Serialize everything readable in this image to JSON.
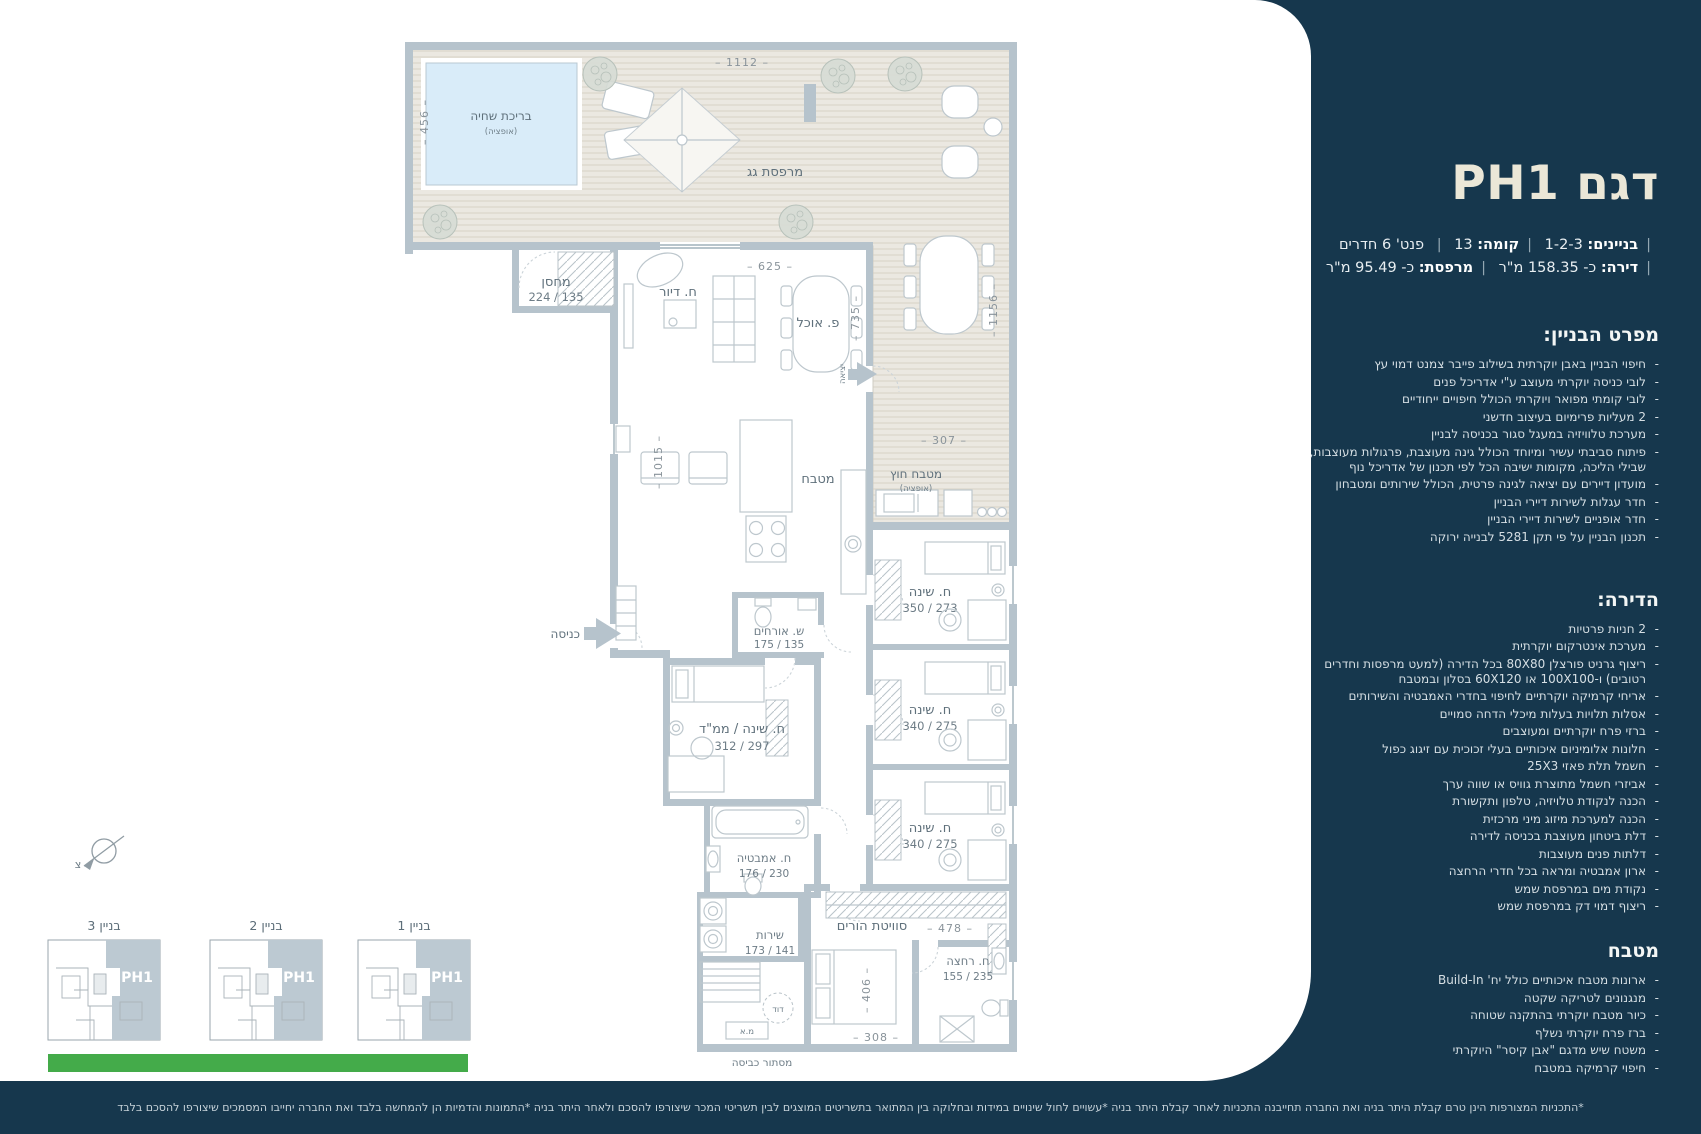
{
  "colors": {
    "navy": "#16374d",
    "cream": "#ebe7d7",
    "green": "#44ab4a",
    "wall": "#b6c3cc",
    "deck": "#ebe8e1",
    "pool": "#d9ecf9",
    "label": "#5f707b",
    "highlight": "#bcc9d2"
  },
  "sidebar": {
    "title": "דגם PH1",
    "separator": "|",
    "meta1": [
      {
        "b": "בניינים:",
        "t": "1-2-3"
      },
      {
        "b": "קומה:",
        "t": "13"
      },
      {
        "b": "",
        "t": "פנט' 6 חדרים"
      }
    ],
    "meta2": [
      {
        "b": "דירה:",
        "t": "כ- 158.35 מ\"ר"
      },
      {
        "b": "מרפסת:",
        "t": "כ- 95.49 מ\"ר"
      }
    ],
    "building_spec": {
      "heading": "מפרט הבניין:",
      "items": [
        "חיפוי הבניין באבן יוקרתית בשילוב פייבר צמנט דמוי עץ",
        "לובי כניסה יוקרתי מעוצב ע\"י אדריכל פנים",
        "לובי קומתי מפואר ויוקרתי הכולל חיפויים ייחודיים",
        "2 מעליות פרימיום בעיצוב חדשני",
        "מערכת טלוויזיה במעגל סגור בכניסה לבניין",
        "פיתוח סביבתי עשיר ומיוחד הכולל גינה מעוצבת, פרגולות מעוצבות, שבילי הליכה, מקומות ישיבה הכל לפי תכנון של אדריכל נוף",
        "מועדון דיירים עם יציאה לגינה פרטית, הכולל שירותים ומטבחון",
        "חדר עגלות לשירות דיירי הבניין",
        "חדר אופניים לשירות דיירי הבניין",
        "תכנון הבניין על פי תקן 5281 לבנייה ירוקה"
      ]
    },
    "apartment_spec": {
      "heading": "הדירה:",
      "items": [
        "2 חניות פרטיות",
        "מערכת אינטרקום יוקרתית",
        "ריצוף גרניט פורצלן 80X80 בכל הדירה (למעט מרפסות וחדרים רטובים) ו-100X100 או 60X120 בסלון ובמטבח",
        "אריחי קרמיקה יוקרתיים לחיפוי בחדרי האמבטיה והשירותים",
        "אסלות תלויות בעלות מיכלי הדחה סמויים",
        "ברזי פרח יוקרתיים ומעוצבים",
        "חלונות אלומיניום איכותיים בעלי זכוכית עם זיגוג כפול",
        "חשמל תלת פאזי 25X3",
        "אביזרי חשמל מתוצרת גוויס או שווה ערך",
        "הכנה לנקודת טלויזיה, טלפון ותקשורת",
        "הכנה למערכת מיזוג מיני מרכזית",
        "דלת ביטחון מעוצבת בכניסה לדירה",
        "דלתות פנים מעוצבות",
        "ארון אמבטיה ומראה בכל חדרי הרחצה",
        "נקודת מים במרפסת שמש",
        "ריצוף דמוי דק במרפסת שמש"
      ]
    },
    "kitchen_spec": {
      "heading": "מטבח",
      "items": [
        "ארונות מטבח איכותיים כולל יח' Build-In",
        "מנגנונים לטריקה שקטה",
        "כיור מטבח יוקרתי בהתקנה שטוחה",
        "ברז פרח יוקרתי נשלף",
        "משטח שיש מדגם \"אבן קיסר\" היוקרתי",
        "חיפוי קרמיקה במטבח"
      ]
    }
  },
  "plan": {
    "labels": {
      "roof_terrace": "מרפסת גג",
      "pool": "בריכת שחיה",
      "option": "(אופציה)",
      "storage": "מחסן",
      "storage_dims": "224 / 135",
      "living": "ח. דיור",
      "dining": "פ. אוכל",
      "kitchen": "מטבח",
      "outdoor_kitchen": "מטבח חוץ",
      "entrance": "כניסה",
      "exit": "יציאה",
      "guest_wc": "ש. אורחים",
      "guest_wc_dims": "175 / 135",
      "mamad": "ח. שינה / ממ\"ד",
      "mamad_dims": "312 / 297",
      "bedroom": "ח. שינה",
      "bedroom1_dims": "350 / 273",
      "bedroom2_dims": "340 / 275",
      "bedroom3_dims": "340 / 275",
      "master": "סוויטת הורים",
      "master_bath": "ח. רחצה",
      "master_bath_dims": "155 / 235",
      "bathroom": "ח. אמבטיה",
      "bathroom_dims": "176 / 230",
      "wc": "שירות",
      "wc_dims": "173 / 141",
      "boiler": "דוד",
      "ac": "מ.א",
      "laundry": "מסתור כביסה",
      "north": "צ"
    },
    "dims": {
      "top": "– 1112 –",
      "pool_left": "– 456 –",
      "living_w": "– 625 –",
      "dining_h": "– 735 –",
      "kitchen_h": "– 1015 –",
      "terrace_h": "– 1156 –",
      "outdoor_kitchen_w": "– 307 –",
      "master_w": "– 478 –",
      "master_bed_h": "– 406 –",
      "master_bottom": "– 308 –"
    }
  },
  "key_plans": {
    "unit_label": "PH1",
    "buildings": [
      "בניין 3",
      "בניין 2",
      "בניין 1"
    ]
  },
  "footer": {
    "disclaimer": "*התכניות המצורפות הינן טרם קבלת היתר בניה ואת החברה תחייבנה התכניות לאחר קבלת היתר בניה *עשויים לחול שינויים במידות ובחלוקה בין המתואר בתשריטים המוצגים לבין תשריטי המכר שיצורפו להסכם ולאחר היתר בניה *התמונות והדמיות הן להמחשה בלבד ואת החברה יחייבו המסמכים שיצורפו להסכם בלבד"
  }
}
